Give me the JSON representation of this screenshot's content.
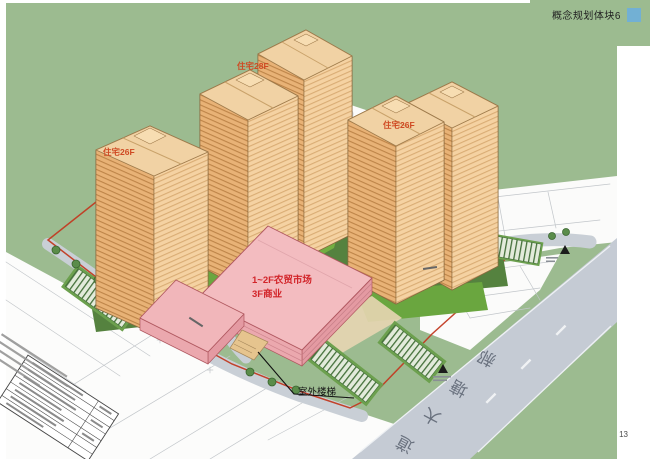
{
  "page": {
    "title": "概念规划体块6",
    "page_number": "13"
  },
  "labels": {
    "tower_left": "住宅26F",
    "tower_center": "住宅28F",
    "tower_right": "住宅26F",
    "market_line1": "1~2F农贸市场",
    "market_line2": "3F商业",
    "outdoor_stairs": "室外楼梯",
    "road_name": "郝塘大道",
    "road_chars": [
      "郝",
      "塘",
      "大",
      "道"
    ]
  },
  "colors": {
    "banner_green": "#9cbb90",
    "accent_blue": "#72b0d4",
    "tower_face": "#e8b276",
    "tower_face_light": "#f5d2a2",
    "tower_roof": "#f1d2a4",
    "market_pink": "#f3bcc0",
    "tower_label_red": "#cf4a23",
    "market_label_red": "#d2252a",
    "road_gray": "#c5cbd4",
    "boundary_red": "#c23a22",
    "lawn_green": "#72ae41",
    "grass_green": "#9cbb90"
  }
}
